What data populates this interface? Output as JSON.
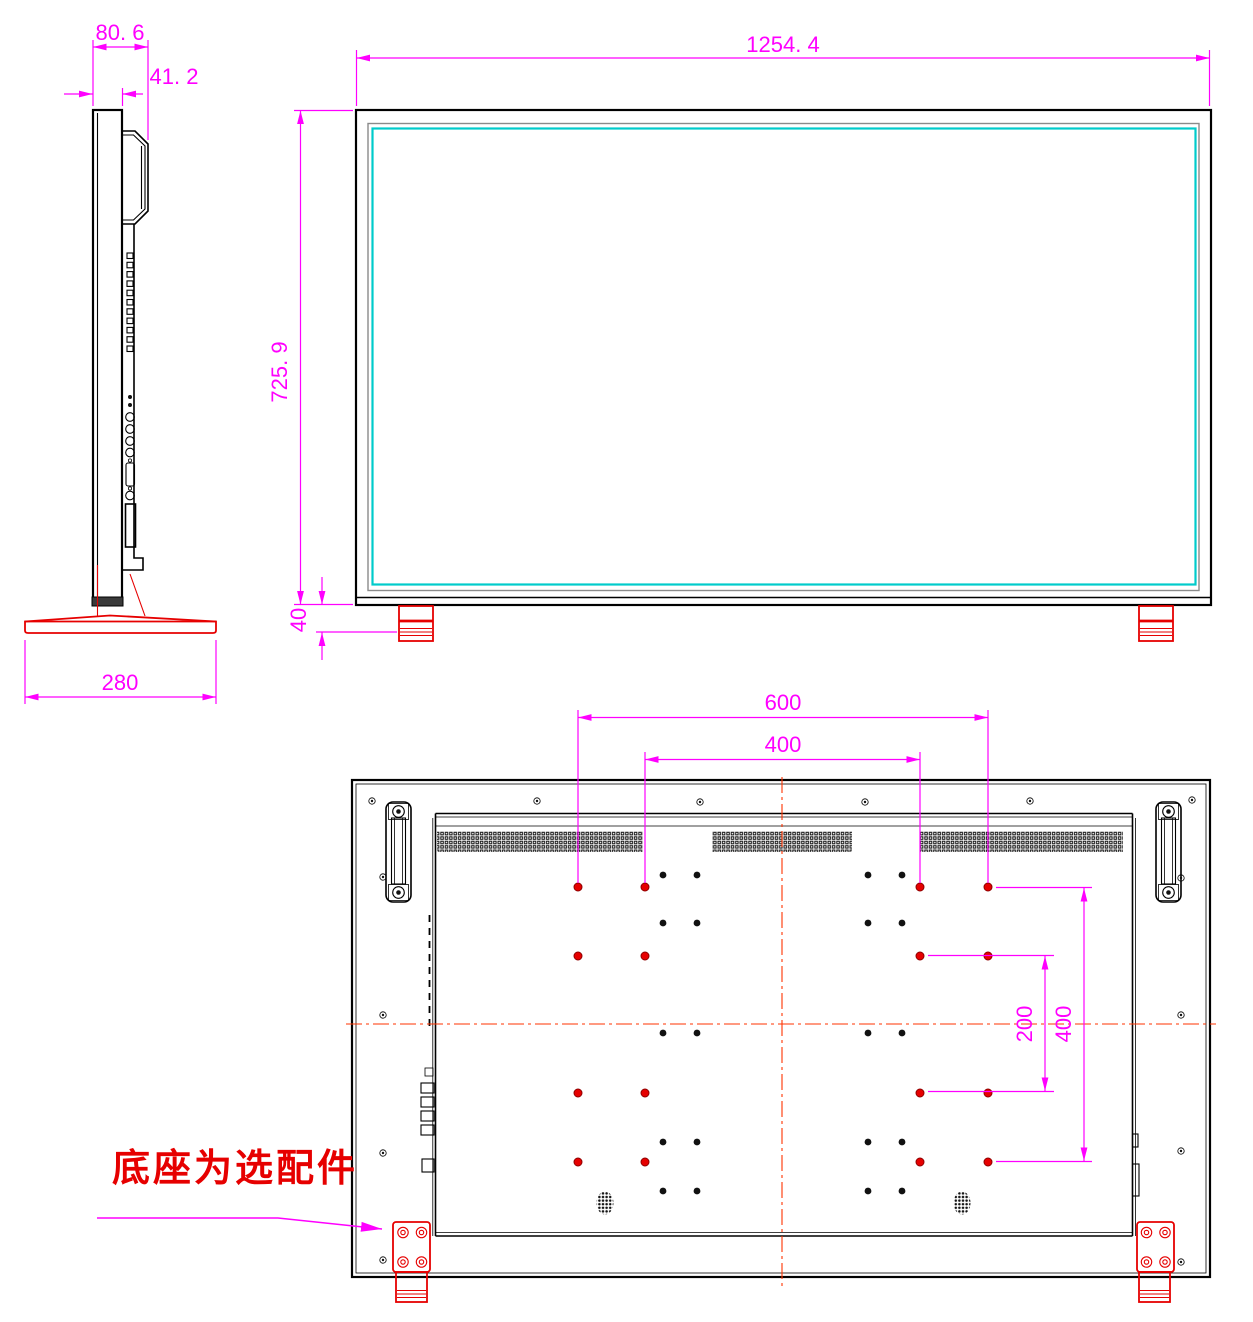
{
  "drawing": {
    "side_view": {
      "depth_total": "80. 6",
      "depth_panel": "41. 2",
      "base_depth": "280"
    },
    "front_view": {
      "width": "1254. 4",
      "height": "725. 9",
      "foot_height": "40"
    },
    "rear_view": {
      "vesa_width_outer": "600",
      "vesa_width_inner": "400",
      "vesa_height_inner": "200",
      "vesa_height_outer": "400"
    },
    "note": {
      "stand_optional": "底座为选配件"
    }
  },
  "colors": {
    "dimension_magenta": "#ff00ff",
    "outline_black": "#000000",
    "accent_red": "#e60000",
    "screen_border_cyan": "#00cbcb",
    "centerline_red": "#ff3300"
  }
}
